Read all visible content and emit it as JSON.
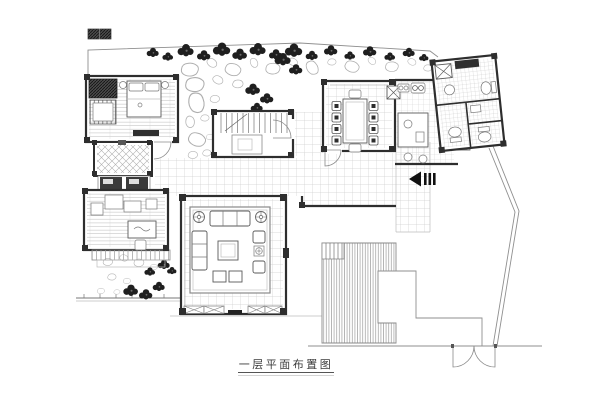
{
  "drawing": {
    "title": "一层平面布置图"
  },
  "icons": {
    "entrance_arrow": "left-filled-triangle-with-three-bars"
  },
  "colors": {
    "background": "#ffffff",
    "wall": "#2e2e2e",
    "tile_grid": "#cfcfcf",
    "furniture_line": "#5a5a5a",
    "site_boundary": "#9a9a9a",
    "deck_hatch": "#9c9c9c",
    "vegetation": "#1f1f1f",
    "stone_outline": "#aeaeae",
    "title_text": "#3c3c3c"
  }
}
